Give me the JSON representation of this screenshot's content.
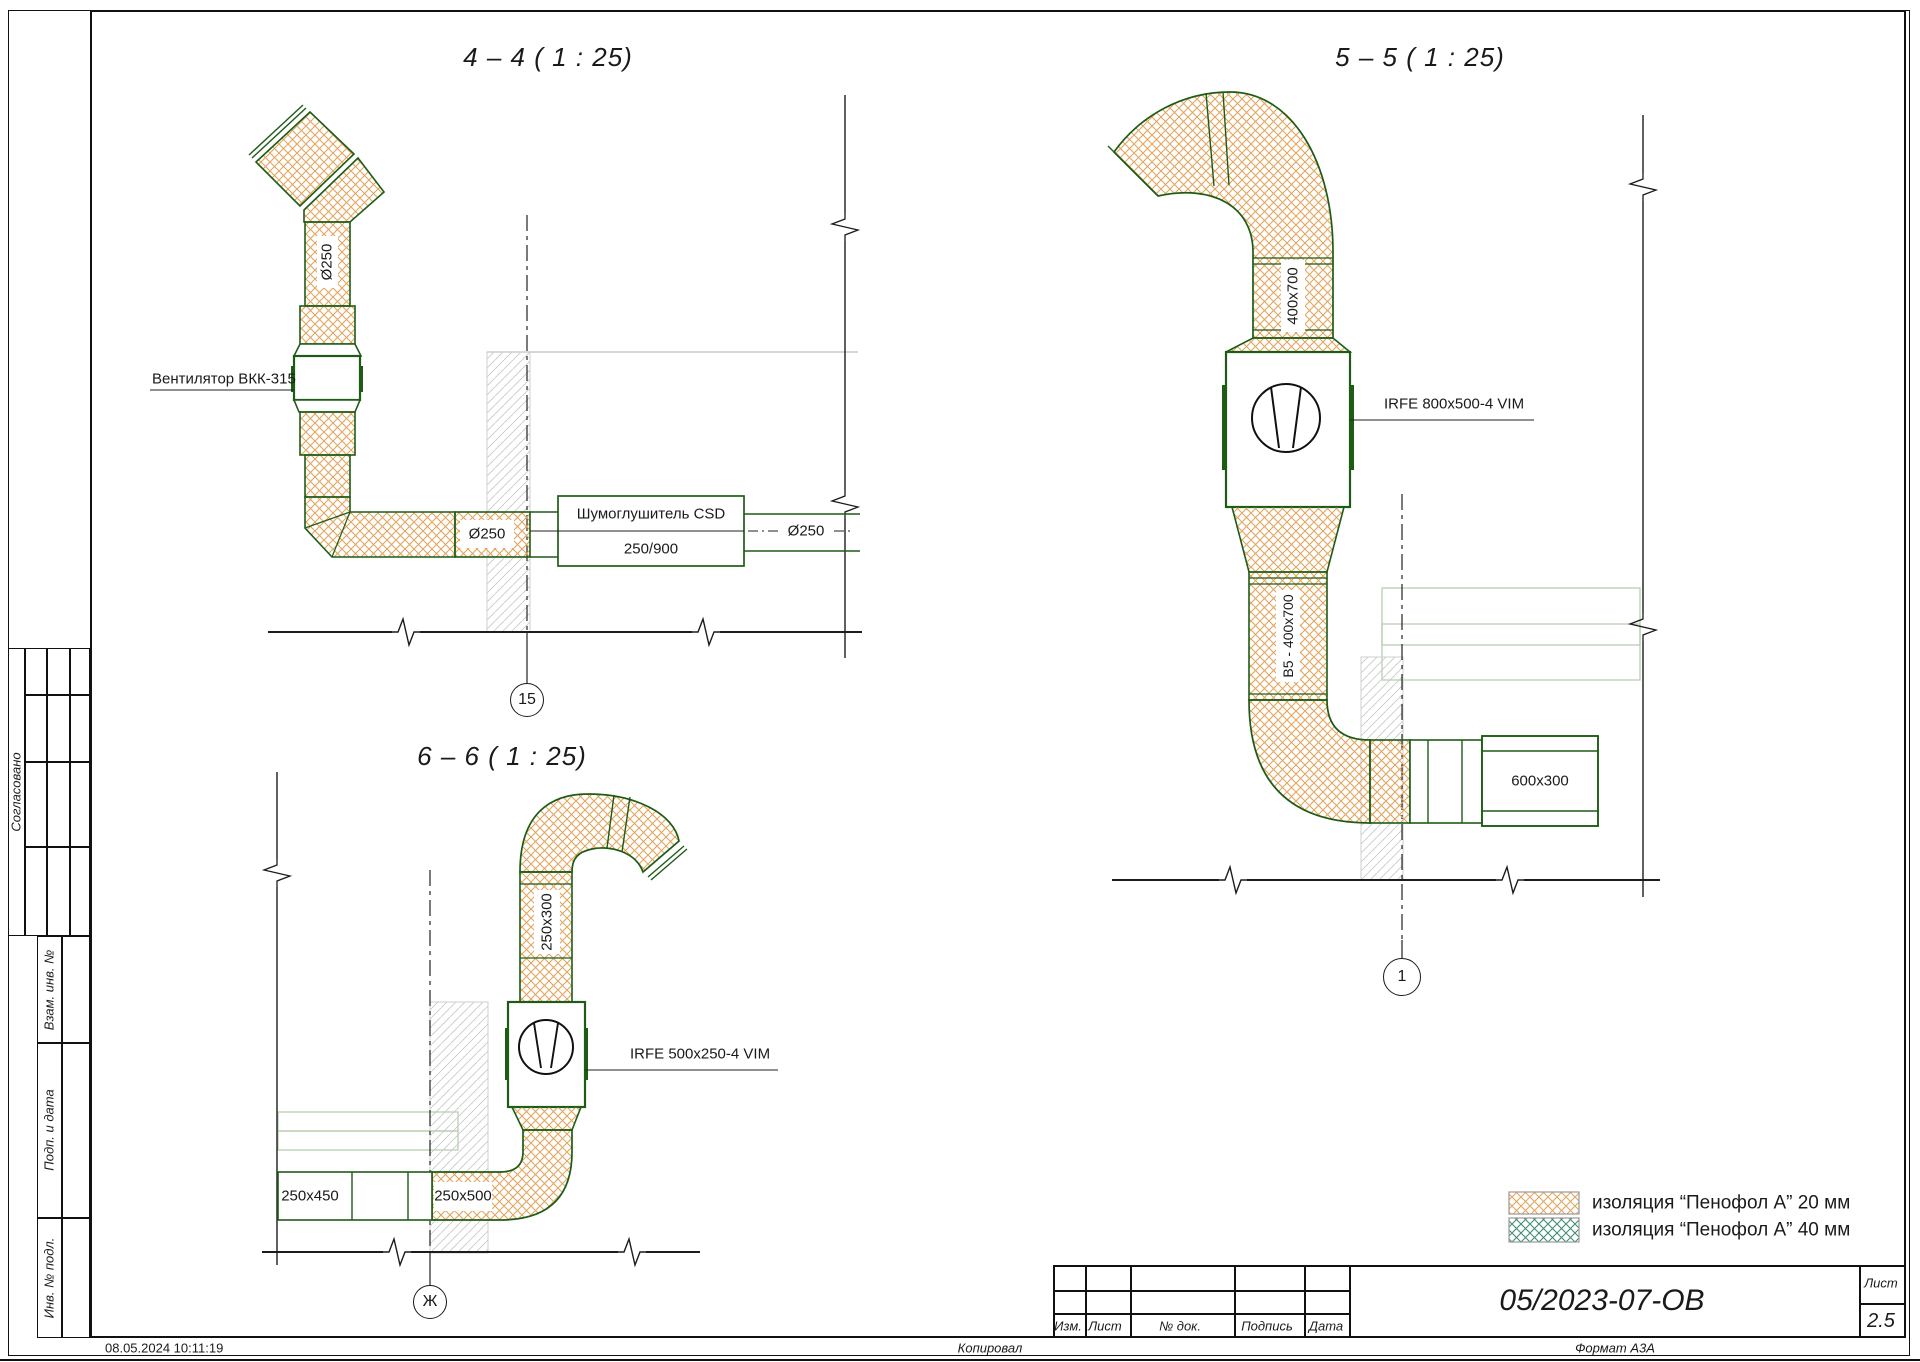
{
  "page": {
    "timestamp": "08.05.2024 10:11:19",
    "copied": "Копировал",
    "format": "Формат А3А"
  },
  "side_stamp": {
    "approved": "Согласовано",
    "subst_inv": "Взам. инв. №",
    "sign_date": "Подп. и дата",
    "inv_orig": "Инв. № подл."
  },
  "title_block": {
    "doc_number": "05/2023-07-ОВ",
    "sheet_label": "Лист",
    "sheet_value": "2.5",
    "columns": [
      "Изм.",
      "Лист",
      "№ док.",
      "Подпись",
      "Дата"
    ]
  },
  "legend": {
    "item1": "изоляция “Пенофол А” 20 мм",
    "item2": "изоляция “Пенофол А” 40 мм"
  },
  "sections": {
    "s44": {
      "title": "4 – 4 ( 1 : 25)",
      "fan_label": "Вентилятор ВКК-315",
      "dia_top": "Ø250",
      "dia_elbow": "Ø250",
      "silencer1": "Шумоглушитель CSD",
      "silencer2": "250/900",
      "dia_right": "Ø250",
      "axis": "15"
    },
    "s55": {
      "title": "5 – 5 ( 1 : 25)",
      "size_top": "400x700",
      "unit": "IRFE 800x500-4 VIM",
      "size_mid": "В5 - 400x700",
      "size_right": "600x300",
      "axis": "1"
    },
    "s66": {
      "title": "6 – 6 ( 1 : 25)",
      "size_top": "250x300",
      "unit": "IRFE 500x250-4 VIM",
      "size_left": "250x450",
      "size_mid": "250x500",
      "axis": "Ж"
    }
  },
  "colors": {
    "duct_green": "#1e5c16",
    "insulation_20mm": "#e2a55e",
    "insulation_40mm": "#3f8e70",
    "wall_hatch": "#c9c9c9",
    "background_duct": "#b7d0b0"
  }
}
